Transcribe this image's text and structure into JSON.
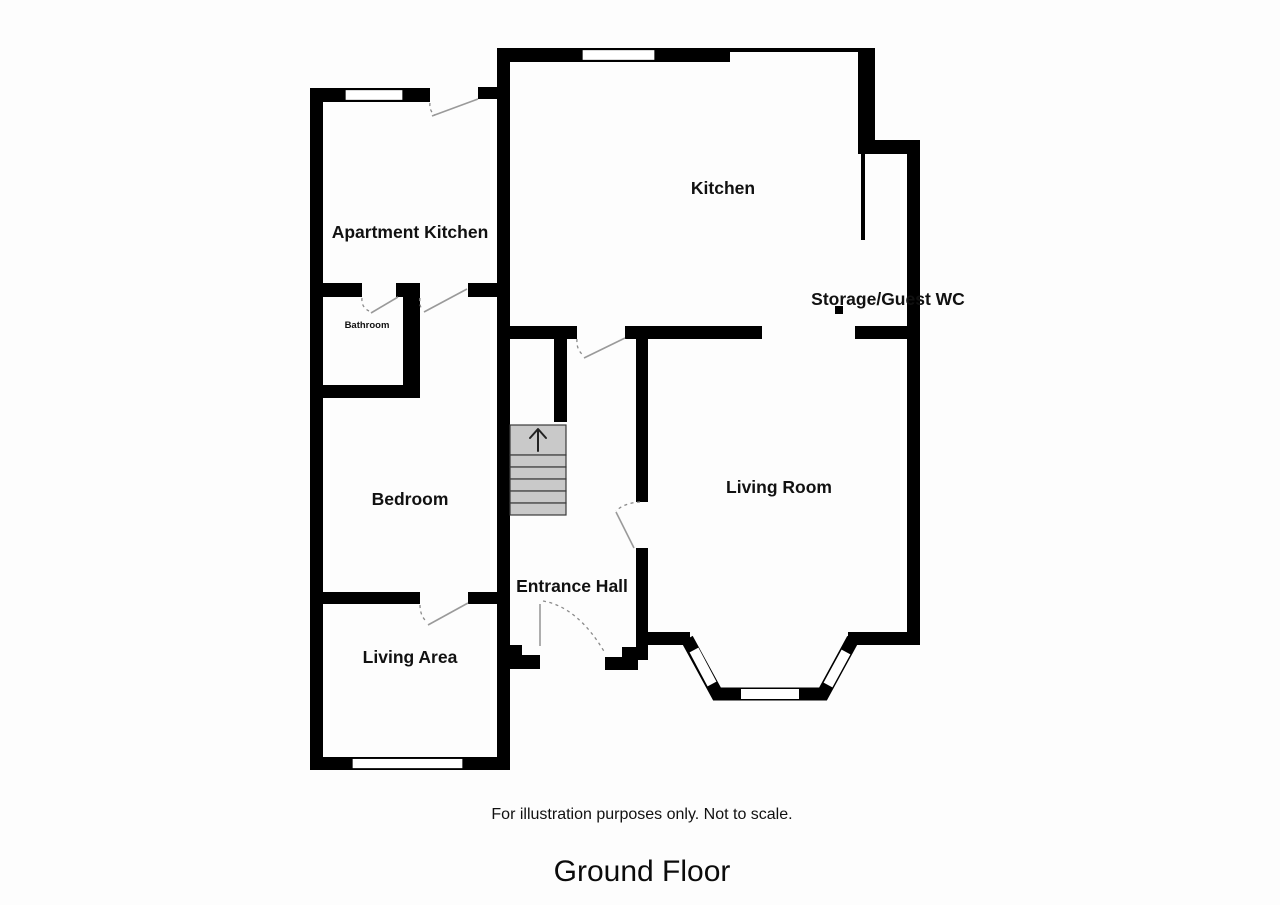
{
  "floorplan": {
    "rooms": {
      "apartment_kitchen": "Apartment Kitchen",
      "kitchen": "Kitchen",
      "storage_guest_wc": "Storage/Guest WC",
      "bathroom": "Bathroom",
      "bedroom": "Bedroom",
      "living_room": "Living Room",
      "entrance_hall": "Entrance Hall",
      "living_area": "Living Area"
    },
    "stairs": {
      "direction_icon": "up-arrow"
    },
    "annotations": {
      "disclaimer": "For illustration purposes only. Not to scale.",
      "floor_title": "Ground Floor"
    },
    "colors": {
      "wall": "#000000",
      "stair_fill": "#c9c9c9",
      "door_swing": "#9a9a9a",
      "window": "#ffffff",
      "background": "#fdfdfd",
      "text": "#111111"
    }
  }
}
